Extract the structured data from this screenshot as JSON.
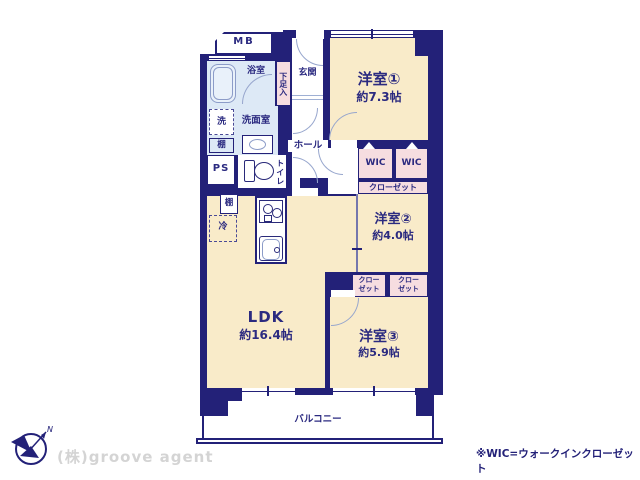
{
  "brand": "(株)groove agent",
  "note": "※WIC=ウォークインクローゼット",
  "compass": {
    "north": "N"
  },
  "rooms": {
    "yoshitsu1": {
      "name": "洋室①",
      "size": "約7.3帖"
    },
    "yoshitsu2": {
      "name": "洋室②",
      "size": "約4.0帖"
    },
    "yoshitsu3": {
      "name": "洋室③",
      "size": "約5.9帖"
    },
    "ldk": {
      "name": "LDK",
      "size": "約16.4帖"
    },
    "balcony": {
      "name": "バルコニー"
    },
    "entrance": {
      "name": "玄関"
    },
    "hall": {
      "name": "ホール"
    },
    "bath": {
      "name": "浴室"
    },
    "washroom": {
      "name": "洗面室"
    },
    "toilet": {
      "name": "トイレ"
    },
    "shoe_box": {
      "name": "下足入"
    }
  },
  "fixtures": {
    "mb": "MB",
    "ps": "PS",
    "washer": "洗",
    "shelf": "棚",
    "fridge": "冷",
    "wic": "WIC",
    "closet": "クローゼット",
    "closet_line1": "クロー",
    "closet_line2": "ゼット"
  },
  "colors": {
    "wall": "#232178",
    "room": "#f9ebc9",
    "wet_area": "#dde9f6",
    "closet": "#f6dde0",
    "fixture_line": "#8c9cc8"
  }
}
